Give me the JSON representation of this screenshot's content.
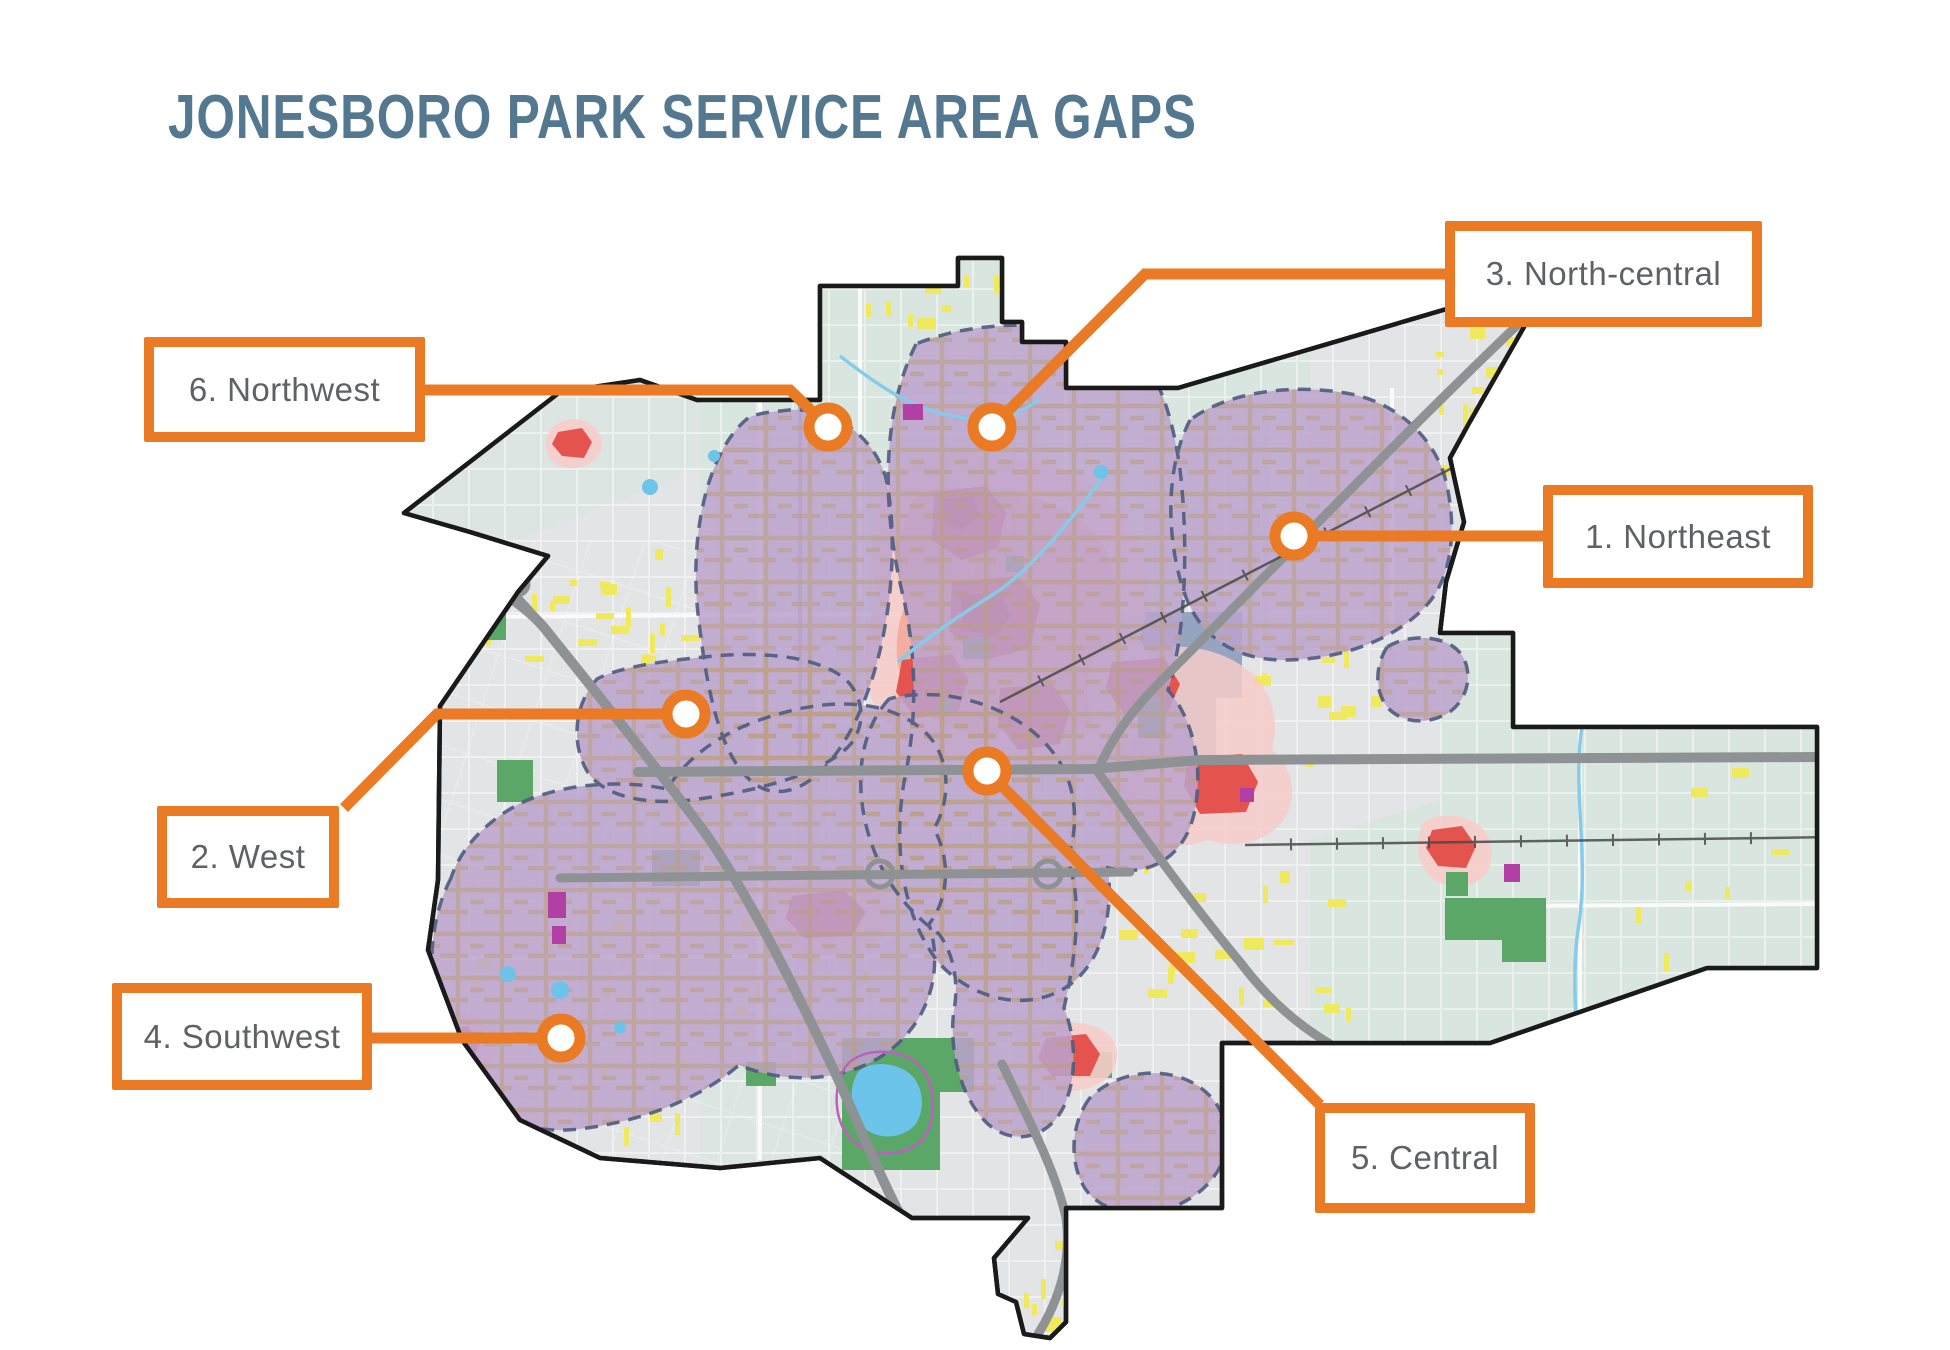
{
  "title": {
    "text": "JONESBORO PARK SERVICE AREA GAPS"
  },
  "colors": {
    "accent_orange": "#EB7A25",
    "title_blue": "#54788F",
    "label_gray": "#5F6163",
    "map_base": "#E3E4E5",
    "map_teal": "#D9E6DF",
    "boundary_black": "#1A1A1A",
    "gap_purple": "#BCA3CE",
    "gap_border_navy": "#4E5C80",
    "gap_roads_tan": "#BD9F85",
    "heat_red": "#E4534E",
    "heat_dark_red": "#C43B3F",
    "heat_salmon": "#F3A896",
    "heat_halo_pink": "#F6CCC9",
    "park_green": "#5BA768",
    "water_blue": "#6CC4EA",
    "street_yellow": "#F0E95E",
    "highway_gray": "#8F9294",
    "downtown_slate": "#8F9DBE",
    "parcel_magenta": "#B13FA4",
    "trail_magenta": "#C05FBF",
    "creek_blue": "#86CBE9"
  },
  "areas": [
    {
      "id": "1",
      "label": "1. Northeast",
      "box": {
        "x": 1543,
        "y": 485,
        "w": 270,
        "h": 103
      },
      "marker": {
        "x": 1294,
        "y": 536
      },
      "leader": [
        [
          1294,
          536
        ],
        [
          1545,
          536
        ]
      ]
    },
    {
      "id": "2",
      "label": "2. West",
      "box": {
        "x": 157,
        "y": 806,
        "w": 182,
        "h": 102
      },
      "marker": {
        "x": 686,
        "y": 714
      },
      "leader": [
        [
          686,
          714
        ],
        [
          437,
          714
        ],
        [
          344,
          808
        ]
      ]
    },
    {
      "id": "3",
      "label": "3. North-central",
      "box": {
        "x": 1445,
        "y": 221,
        "w": 317,
        "h": 106
      },
      "marker": {
        "x": 992,
        "y": 427
      },
      "leader": [
        [
          992,
          427
        ],
        [
          1145,
          274
        ],
        [
          1449,
          274
        ]
      ]
    },
    {
      "id": "4",
      "label": "4. Southwest",
      "box": {
        "x": 112,
        "y": 983,
        "w": 260,
        "h": 107
      },
      "marker": {
        "x": 561,
        "y": 1038
      },
      "leader": [
        [
          561,
          1038
        ],
        [
          370,
          1038
        ]
      ]
    },
    {
      "id": "5",
      "label": "5. Central",
      "box": {
        "x": 1315,
        "y": 1103,
        "w": 220,
        "h": 110
      },
      "marker": {
        "x": 987,
        "y": 771
      },
      "leader": [
        [
          987,
          771
        ],
        [
          1320,
          1105
        ]
      ]
    },
    {
      "id": "6",
      "label": "6. Northwest",
      "box": {
        "x": 144,
        "y": 337,
        "w": 281,
        "h": 105
      },
      "marker": {
        "x": 828,
        "y": 427
      },
      "leader": [
        [
          828,
          427
        ],
        [
          790,
          390
        ],
        [
          423,
          390
        ]
      ]
    }
  ]
}
